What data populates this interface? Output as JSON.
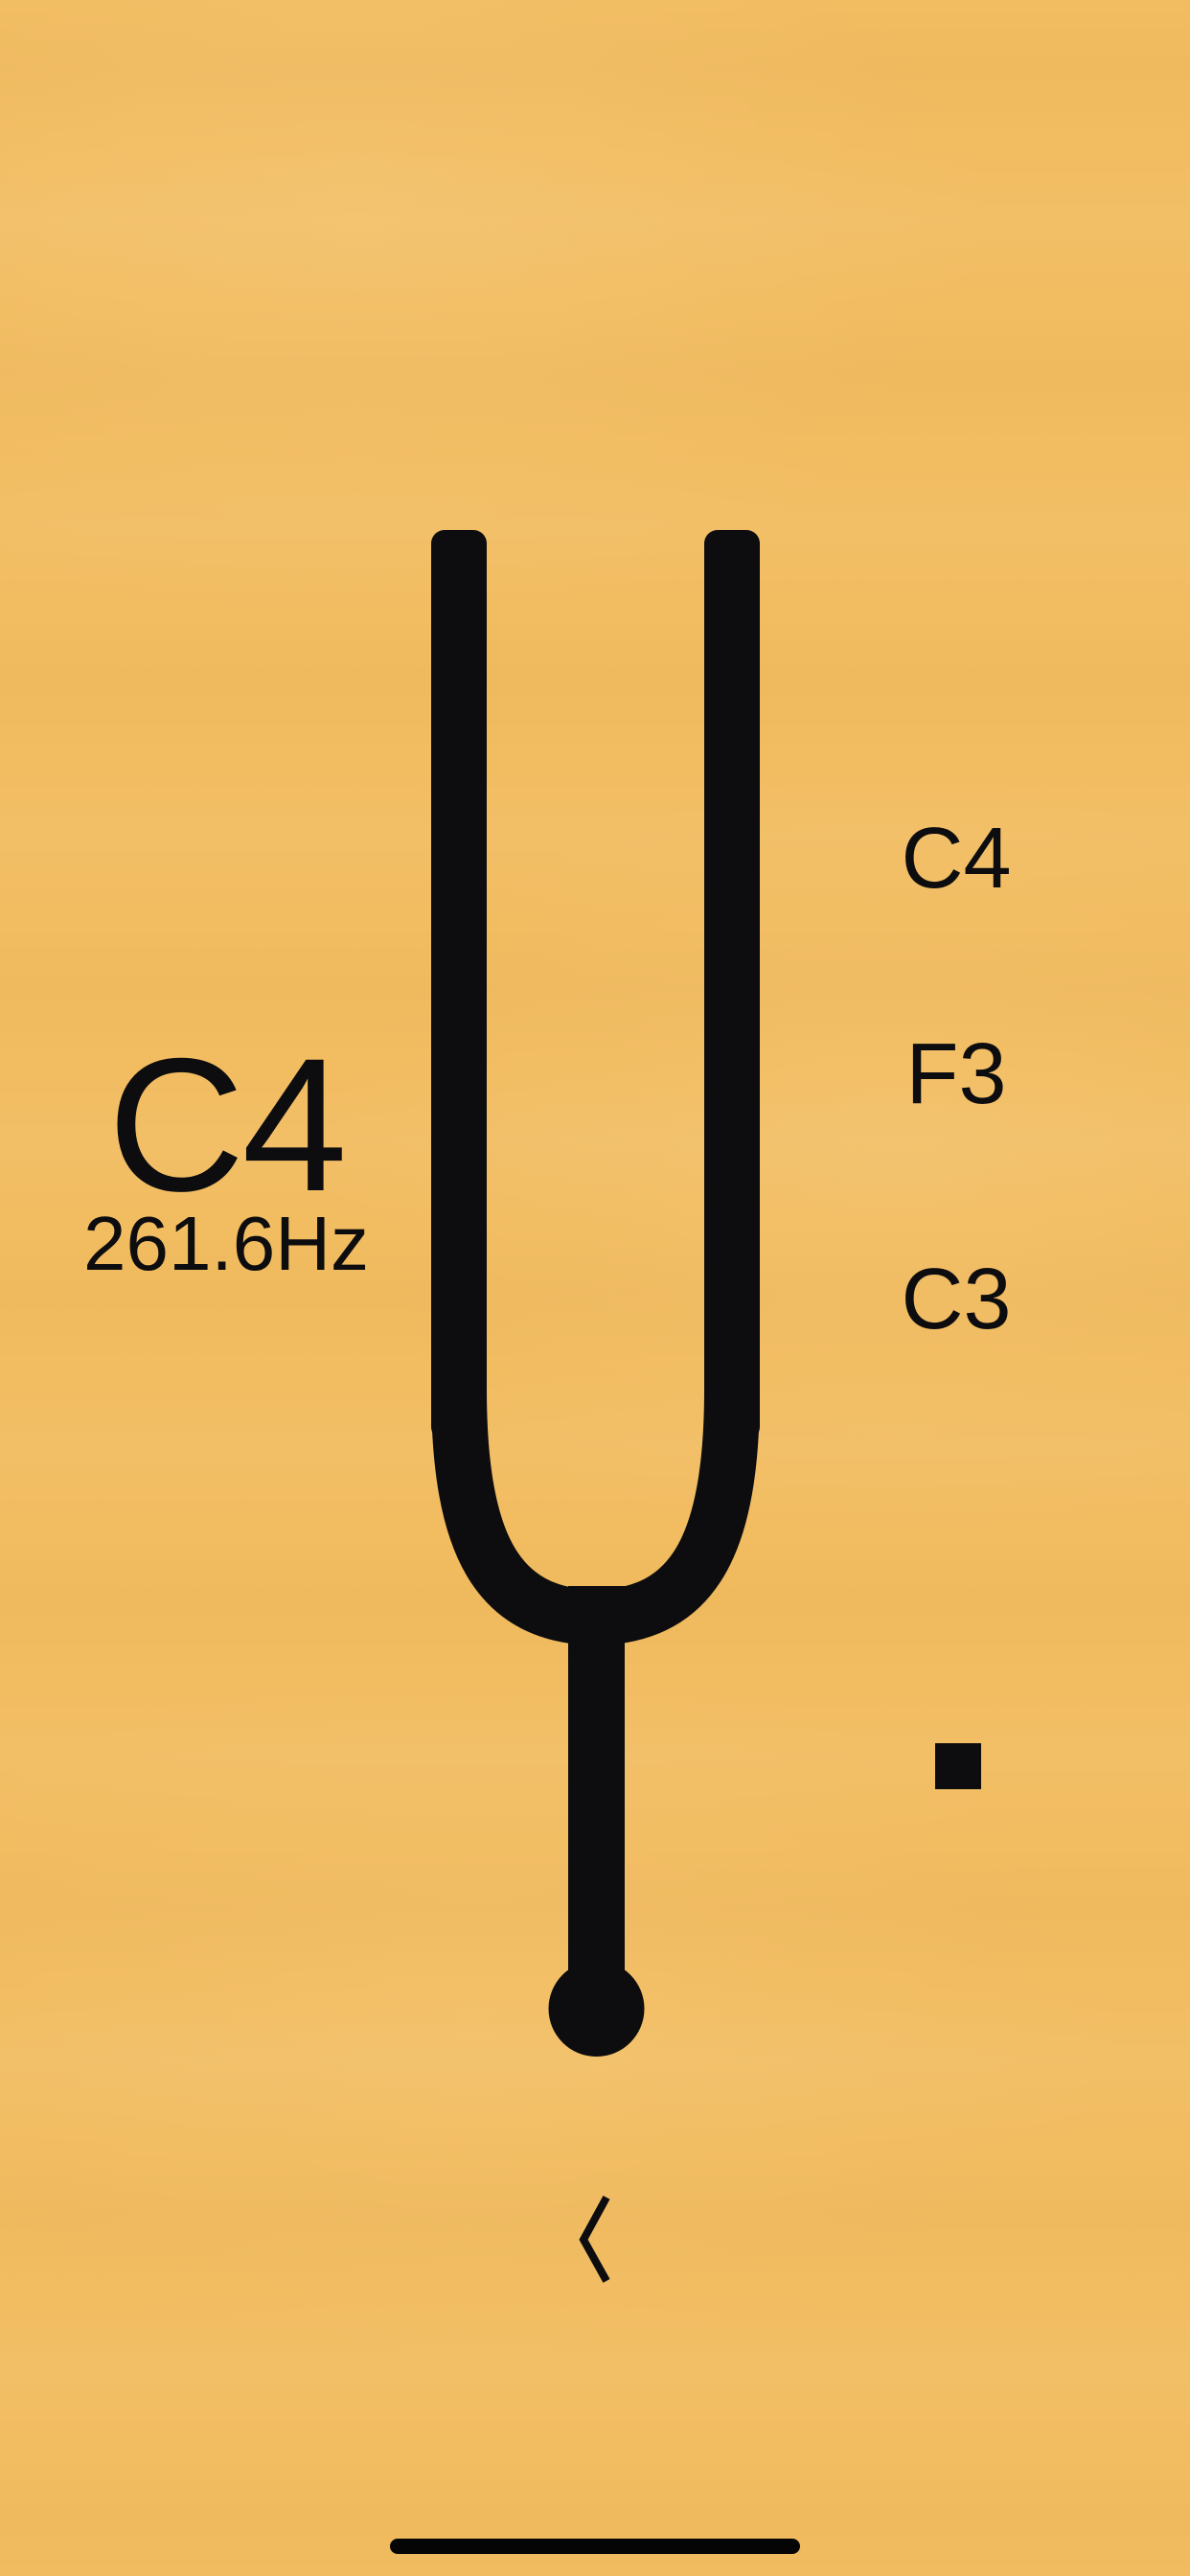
{
  "note_display": {
    "note": "C4",
    "frequency": "261.6Hz"
  },
  "note_selector": {
    "options": [
      {
        "label": "C4"
      },
      {
        "label": "F3"
      },
      {
        "label": "C3"
      }
    ]
  },
  "controls": {
    "stop": "stop-icon",
    "back": "chevron-left-icon"
  },
  "colors": {
    "background": "#f2bc60",
    "ink": "#0d0d0f"
  }
}
